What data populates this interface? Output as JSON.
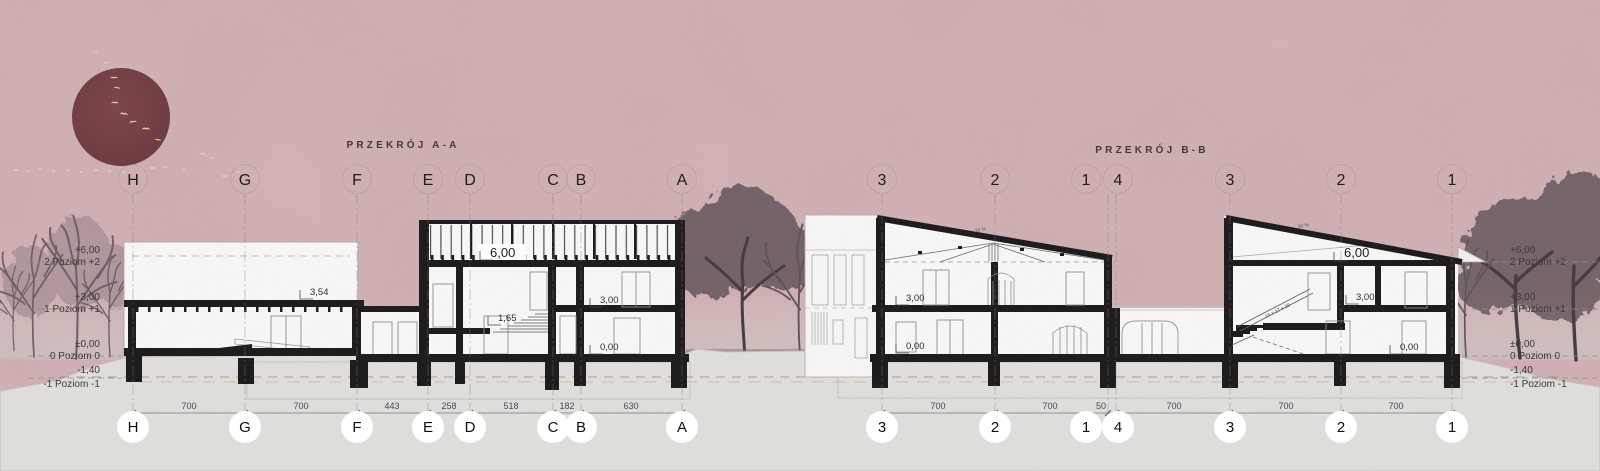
{
  "colors": {
    "background": "#d5b5b7",
    "sun": "#6e3a3e",
    "birds": "#ead9a8",
    "ink": "#151515",
    "ground": "#e4e3e0",
    "trees": "#55484e",
    "faint_line": "#8a8486"
  },
  "titles": {
    "section_a": "PRZEKRÓJ A-A",
    "section_b": "PRZEKRÓJ B-B"
  },
  "section_a": {
    "grid": [
      "H",
      "G",
      "F",
      "E",
      "D",
      "C",
      "B",
      "A"
    ],
    "dims": [
      "700",
      "700",
      "443",
      "258",
      "518",
      "182",
      "630"
    ],
    "marks": {
      "roof": "6,00",
      "parapet": "3,54",
      "stair_mid": "1,65",
      "floor_1": "3,00",
      "floor_0": "0,00"
    }
  },
  "section_b": {
    "grid": [
      "3",
      "2",
      "1",
      "4",
      "3",
      "2",
      "1"
    ],
    "dims": [
      "700",
      "700",
      "50",
      "700",
      "700",
      "700"
    ],
    "left": {
      "floor_1": "3,00",
      "floor_0": "0,00",
      "slope": "10 %"
    },
    "right": {
      "roof": "6,00",
      "floor_1": "3,00",
      "floor_0": "0,00",
      "slope": "10 %",
      "stair_note": "16 x 17 x 29"
    }
  },
  "levels": {
    "left": [
      {
        "elev": "+6,00",
        "name": "2 Poziom +2"
      },
      {
        "elev": "+3,00",
        "name": "1 Poziom +1"
      },
      {
        "elev": "±0,00",
        "name": "0 Poziom 0"
      },
      {
        "elev": "-1,40",
        "name": "-1 Poziom -1"
      }
    ],
    "right": [
      {
        "elev": "+6,00",
        "name": "2 Poziom +2"
      },
      {
        "elev": "+3,00",
        "name": "1 Poziom +1"
      },
      {
        "elev": "±0,00",
        "name": "0 Poziom 0"
      },
      {
        "elev": "-1,40",
        "name": "-1 Poziom -1"
      }
    ]
  }
}
